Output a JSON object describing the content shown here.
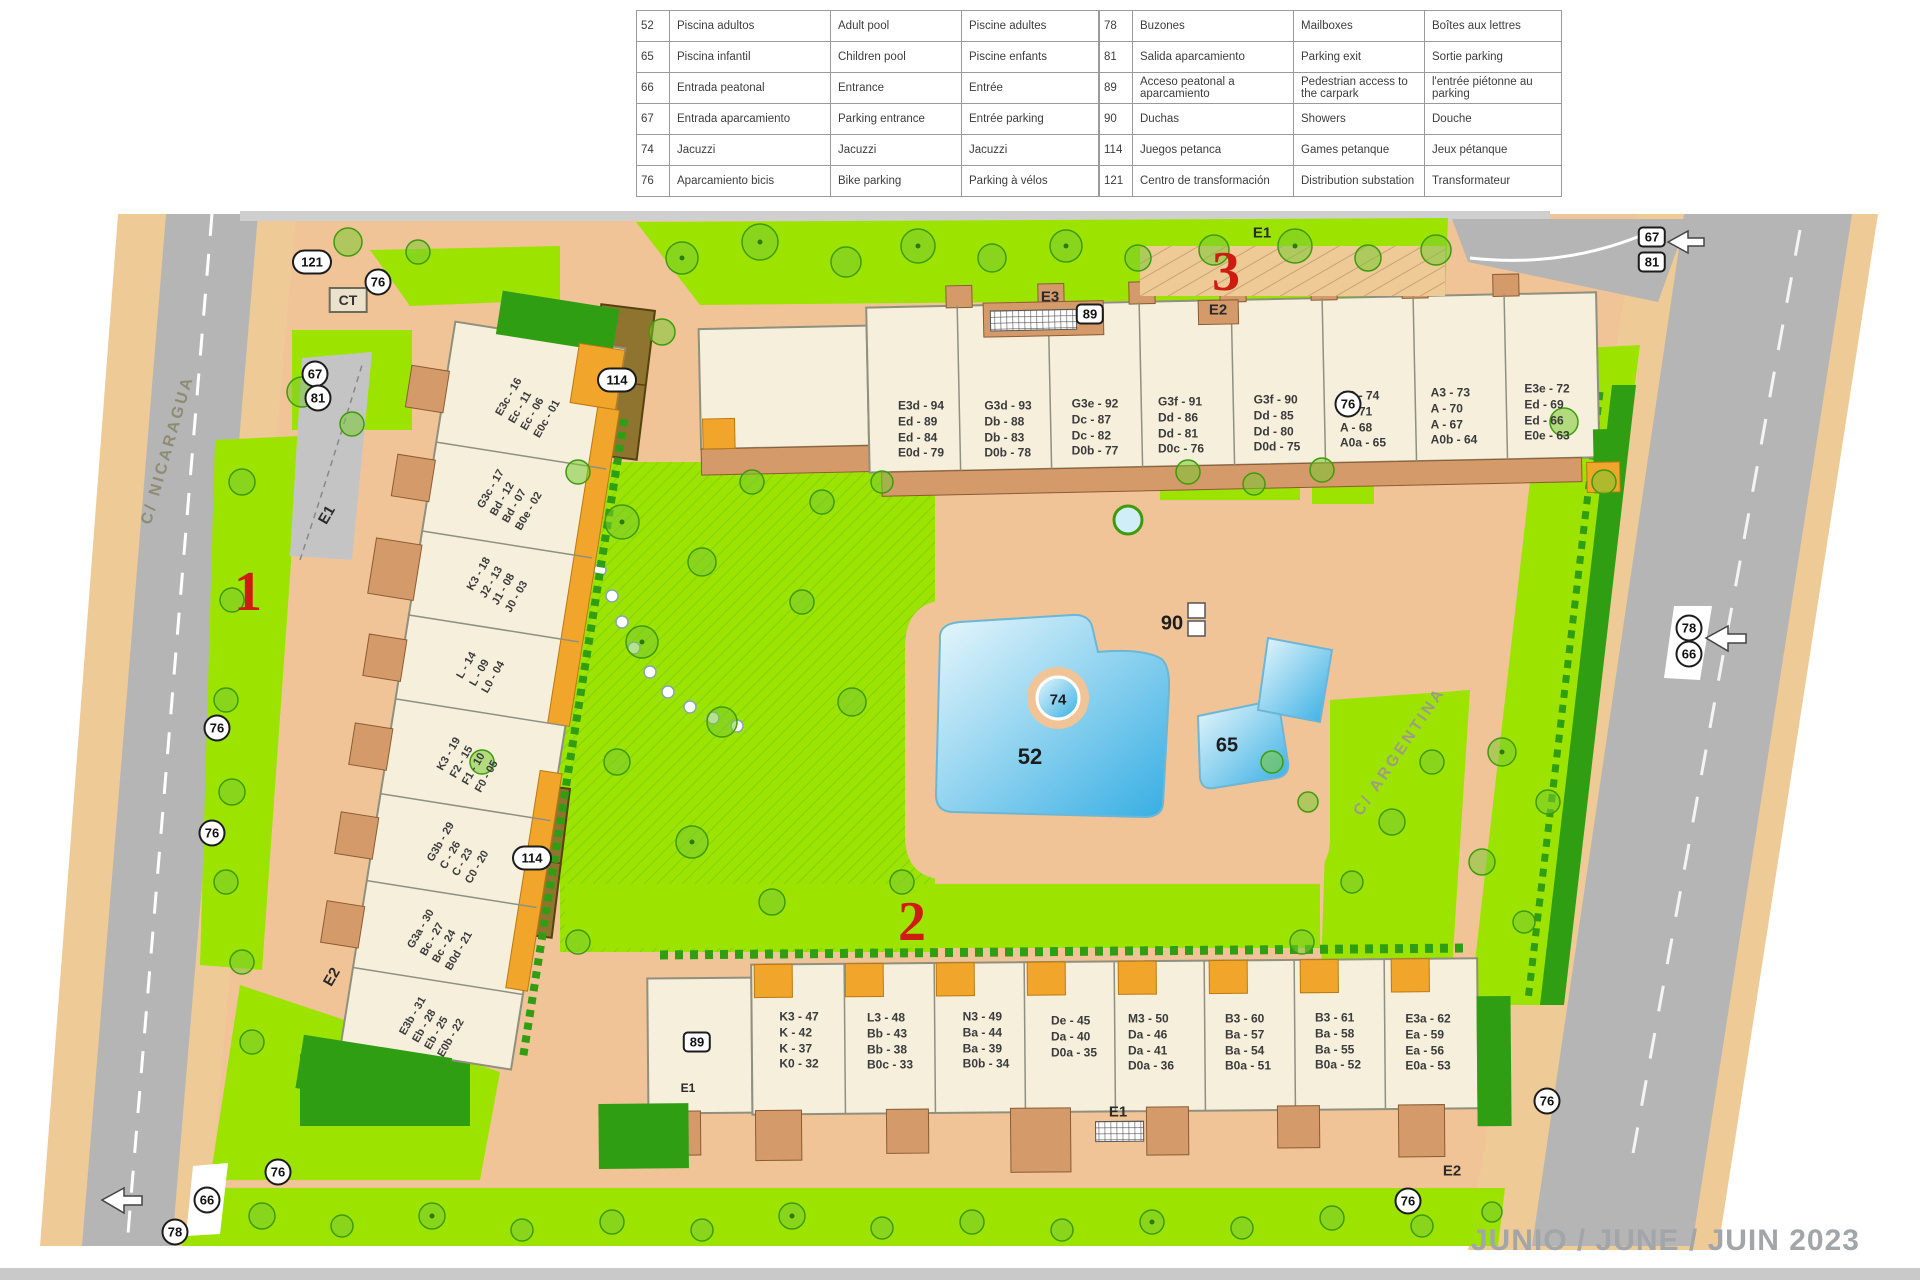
{
  "legend": {
    "left_rows": [
      {
        "num": "52",
        "es": "Piscina adultos",
        "en": "Adult pool",
        "fr": "Piscine adultes"
      },
      {
        "num": "65",
        "es": "Piscina infantil",
        "en": "Children pool",
        "fr": "Piscine enfants"
      },
      {
        "num": "66",
        "es": "Entrada peatonal",
        "en": "Entrance",
        "fr": "Entrée"
      },
      {
        "num": "67",
        "es": "Entrada aparcamiento",
        "en": "Parking entrance",
        "fr": "Entrée parking"
      },
      {
        "num": "74",
        "es": "Jacuzzi",
        "en": "Jacuzzi",
        "fr": "Jacuzzi"
      },
      {
        "num": "76",
        "es": "Aparcamiento bicis",
        "en": "Bike parking",
        "fr": "Parking à vélos"
      }
    ],
    "right_rows": [
      {
        "num": "78",
        "es": "Buzones",
        "en": "Mailboxes",
        "fr": "Boîtes aux lettres"
      },
      {
        "num": "81",
        "es": "Salida aparcamiento",
        "en": "Parking exit",
        "fr": "Sortie parking"
      },
      {
        "num": "89",
        "es": "Acceso peatonal a aparcamiento",
        "en": "Pedestrian access to the carpark",
        "fr": "l'entrée piétonne au parking"
      },
      {
        "num": "90",
        "es": "Duchas",
        "en": "Showers",
        "fr": "Douche"
      },
      {
        "num": "114",
        "es": "Juegos petanca",
        "en": "Games petanque",
        "fr": "Jeux pétanque"
      },
      {
        "num": "121",
        "es": "Centro de transformación",
        "en": "Distribution substation",
        "fr": "Transformateur"
      }
    ]
  },
  "map": {
    "streets": {
      "west": "C/ NICARAGUA",
      "east": "C/ ARGENTINA"
    },
    "zones": {
      "z1": "1",
      "z2": "2",
      "z3": "3"
    },
    "date_stamp": "JUNIO / JUNE / JUIN 2023",
    "labels": {
      "n52": "52",
      "n65": "65",
      "n66": "66",
      "n67": "67",
      "n74": "74",
      "n76": "76",
      "n78": "78",
      "n81": "81",
      "n89": "89",
      "n90": "90",
      "n114": "114",
      "n121": "121",
      "ct": "CT",
      "e1": "E1",
      "e2": "E2",
      "e3": "E3"
    },
    "buildings": {
      "north_blocks": [
        "E3d - 94\nEd - 89\nEd - 84\nE0d - 79",
        "G3d - 93\nDb - 88\nDb - 83\nD0b - 78",
        "G3e - 92\nDc - 87\nDc - 82\nD0b - 77",
        "G3f - 91\nDd - 86\nDd - 81\nD0c - 76",
        "G3f - 90\nDd - 85\nDd - 80\nD0d - 75",
        "A3 - 74\nA - 71\nA - 68\nA0a - 65",
        "A3 - 73\nA - 70\nA - 67\nA0b - 64",
        "E3e - 72\nEd - 69\nEd - 66\nE0e - 63"
      ],
      "west_blocks": [
        "E3c - 16\nEc - 11\nEc - 06\nE0c - 01",
        "G3c - 17\nBd - 12\nBd - 07\nB0e - 02",
        "K3 - 18\nJ2 - 13\nJ1 - 08\nJ0 - 03",
        "L - 14\nL - 09\nL0 - 04",
        "K3 - 19\nF2 - 15\nF1 - 10\nF0 - 05",
        "G3b - 29\nC - 26\nC - 23\nC0 - 20",
        "G3a - 30\nBc - 27\nBc - 24\nB0d - 21",
        "E3b - 31\nEb - 28\nEb - 25\nE0b - 22"
      ],
      "south_blocks": [
        "K3 - 47\nK - 42\nK - 37\nK0 - 32",
        "L3 - 48\nBb - 43\nBb - 38\nB0c - 33",
        "N3 - 49\nBa - 44\nBa - 39\nB0b - 34",
        "De - 45\nDa - 40\nD0a - 35",
        "M3 - 50\nDa - 46\nDa - 41\nD0a - 36",
        "B3 - 60\nBa - 57\nBa - 54\nB0a - 51",
        "B3 - 61\nBa - 58\nBa - 55\nB0a - 52",
        "E3a - 62\nEa - 59\nEa - 56\nE0a - 53"
      ]
    }
  }
}
